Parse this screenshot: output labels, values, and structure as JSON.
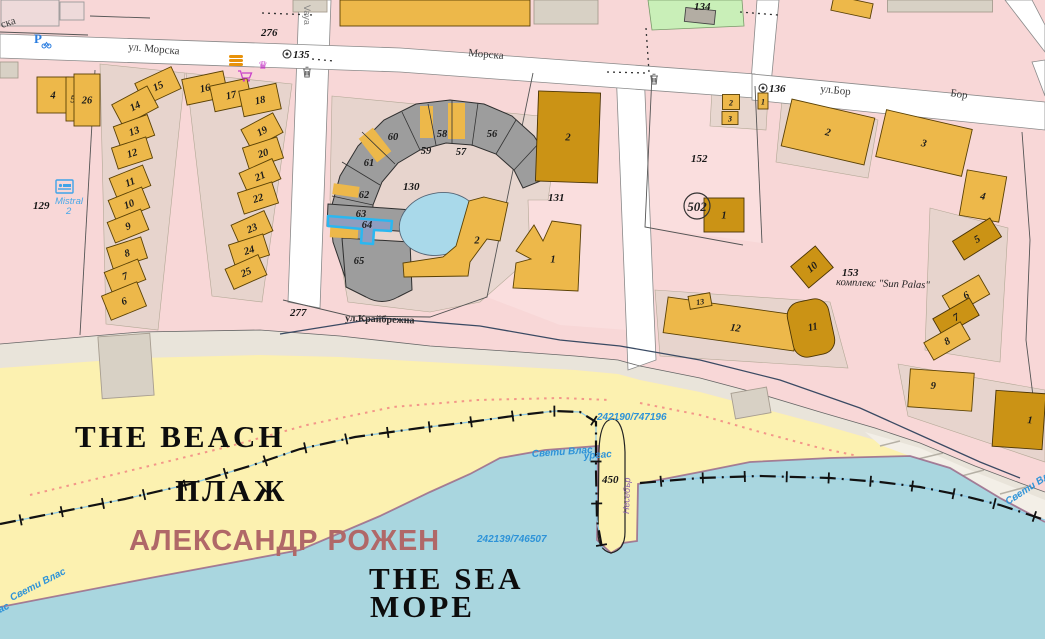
{
  "map": {
    "colors": {
      "urban": "#f8d7d7",
      "road": "#ffffff",
      "beach": "#fcf1b0",
      "sea": "#a9d6df",
      "dune": "#e9e4da",
      "courtyard": "#d8d1c5",
      "green_parcel": "#c9efb8",
      "pond": "#a9d9ea",
      "selected_fill": "#8f9dbf",
      "selected_stroke": "#2bb7f0",
      "shore_edge": "#9b6a8a",
      "blue_text": "#2e93d8",
      "beach_name_text": "#b06868",
      "building_fills": {
        "L": "#edb84a",
        "D": "#cb9315",
        "G": "#9d9d9d",
        "T": "#d8d1c5",
        "P2": "#eedada",
        "G2": "#b3ada3"
      }
    },
    "selected_parcel": {
      "label": "64",
      "note_cls": "highlighted with cyan outline"
    },
    "icons": [
      {
        "name": "parking-icon"
      },
      {
        "name": "hotel-bed-icon"
      },
      {
        "name": "trash-icon"
      },
      {
        "name": "trash-icon"
      },
      {
        "name": "restaurant-icon"
      },
      {
        "name": "crown-icon"
      },
      {
        "name": "shopping-cart-icon"
      },
      {
        "name": "boundary-marker-135"
      },
      {
        "name": "boundary-marker-136"
      }
    ],
    "buildings": [
      {
        "n": "4",
        "x": 53,
        "y": 95,
        "w": 32,
        "h": 36,
        "r": 0,
        "c": "L"
      },
      {
        "n": "5",
        "x": 73,
        "y": 99,
        "w": 14,
        "h": 44,
        "r": 0,
        "c": "L"
      },
      {
        "n": "26",
        "x": 87,
        "y": 100,
        "w": 26,
        "h": 52,
        "r": 0,
        "c": "L"
      },
      {
        "n": "15",
        "x": 158,
        "y": 86,
        "w": 40,
        "h": 24,
        "r": -25,
        "c": "L"
      },
      {
        "n": "14",
        "x": 135,
        "y": 106,
        "w": 40,
        "h": 24,
        "r": -28,
        "c": "L"
      },
      {
        "n": "13",
        "x": 134,
        "y": 131,
        "w": 36,
        "h": 22,
        "r": -20,
        "c": "L"
      },
      {
        "n": "12",
        "x": 132,
        "y": 153,
        "w": 36,
        "h": 22,
        "r": -18,
        "c": "L"
      },
      {
        "n": "11",
        "x": 130,
        "y": 182,
        "w": 36,
        "h": 22,
        "r": -22,
        "c": "L"
      },
      {
        "n": "10",
        "x": 129,
        "y": 204,
        "w": 36,
        "h": 22,
        "r": -22,
        "c": "L"
      },
      {
        "n": "9",
        "x": 128,
        "y": 226,
        "w": 36,
        "h": 22,
        "r": -22,
        "c": "L"
      },
      {
        "n": "8",
        "x": 127,
        "y": 253,
        "w": 36,
        "h": 22,
        "r": -18,
        "c": "L"
      },
      {
        "n": "7",
        "x": 125,
        "y": 276,
        "w": 36,
        "h": 22,
        "r": -22,
        "c": "L"
      },
      {
        "n": "6",
        "x": 124,
        "y": 301,
        "w": 38,
        "h": 26,
        "r": -22,
        "c": "L"
      },
      {
        "n": "16",
        "x": 205,
        "y": 88,
        "w": 42,
        "h": 26,
        "r": -12,
        "c": "L"
      },
      {
        "n": "17",
        "x": 231,
        "y": 95,
        "w": 38,
        "h": 26,
        "r": -12,
        "c": "L"
      },
      {
        "n": "18",
        "x": 260,
        "y": 100,
        "w": 38,
        "h": 26,
        "r": -12,
        "c": "L"
      },
      {
        "n": "19",
        "x": 262,
        "y": 131,
        "w": 36,
        "h": 22,
        "r": -28,
        "c": "L"
      },
      {
        "n": "20",
        "x": 263,
        "y": 153,
        "w": 36,
        "h": 22,
        "r": -18,
        "c": "L"
      },
      {
        "n": "21",
        "x": 260,
        "y": 176,
        "w": 36,
        "h": 22,
        "r": -24,
        "c": "L"
      },
      {
        "n": "22",
        "x": 258,
        "y": 198,
        "w": 36,
        "h": 22,
        "r": -18,
        "c": "L"
      },
      {
        "n": "23",
        "x": 252,
        "y": 228,
        "w": 36,
        "h": 22,
        "r": -24,
        "c": "L"
      },
      {
        "n": "24",
        "x": 249,
        "y": 250,
        "w": 36,
        "h": 22,
        "r": -18,
        "c": "L"
      },
      {
        "n": "25",
        "x": 246,
        "y": 272,
        "w": 36,
        "h": 22,
        "r": -24,
        "c": "L"
      },
      {
        "n": "2",
        "pts": [
          [
            484,
            197
          ],
          [
            508,
            203
          ],
          [
            500,
            241
          ],
          [
            487,
            239
          ],
          [
            470,
            262
          ],
          [
            468,
            276
          ],
          [
            404,
            277
          ],
          [
            403,
            263
          ],
          [
            443,
            257
          ],
          [
            456,
            246
          ],
          [
            469,
            201
          ]
        ],
        "c": "L",
        "lx": 477,
        "ly": 240
      },
      {
        "n": "1",
        "pts": [
          [
            516,
            251
          ],
          [
            534,
            225
          ],
          [
            543,
            241
          ],
          [
            552,
            221
          ],
          [
            581,
            225
          ],
          [
            578,
            291
          ],
          [
            513,
            288
          ],
          [
            516,
            263
          ],
          [
            531,
            259
          ]
        ],
        "c": "L",
        "lx": 553,
        "ly": 259
      },
      {
        "n": "2",
        "x": 568,
        "y": 137,
        "w": 62,
        "h": 90,
        "r": 2,
        "c": "D"
      },
      {
        "n": "2",
        "x": 731,
        "y": 102,
        "w": 17,
        "h": 15,
        "r": 0,
        "c": "L",
        "fs": 1
      },
      {
        "n": "3",
        "x": 730,
        "y": 118,
        "w": 16,
        "h": 13,
        "r": 0,
        "c": "L",
        "fs": 1
      },
      {
        "n": "1",
        "x": 763,
        "y": 101,
        "w": 10,
        "h": 16,
        "r": 0,
        "c": "L",
        "fs": 1
      },
      {
        "n": "1",
        "x": 724,
        "y": 215,
        "w": 40,
        "h": 34,
        "r": 0,
        "c": "D"
      },
      {
        "n": "2",
        "x": 828,
        "y": 132,
        "w": 85,
        "h": 48,
        "r": 13,
        "c": "L"
      },
      {
        "n": "3",
        "x": 924,
        "y": 143,
        "w": 88,
        "h": 48,
        "r": 13,
        "c": "L"
      },
      {
        "n": "4",
        "x": 983,
        "y": 196,
        "w": 40,
        "h": 46,
        "r": 10,
        "c": "L"
      },
      {
        "n": "5",
        "x": 977,
        "y": 239,
        "w": 44,
        "h": 22,
        "r": -32,
        "c": "D"
      },
      {
        "n": "6",
        "x": 966,
        "y": 295,
        "w": 42,
        "h": 22,
        "r": -30,
        "c": "L"
      },
      {
        "n": "7",
        "x": 956,
        "y": 317,
        "w": 42,
        "h": 20,
        "r": -30,
        "c": "D"
      },
      {
        "n": "8",
        "x": 947,
        "y": 341,
        "w": 42,
        "h": 20,
        "r": -30,
        "c": "L"
      },
      {
        "n": "9",
        "x": 941,
        "y": 390,
        "w": 64,
        "h": 38,
        "r": 4,
        "c": "L",
        "lx": 933,
        "ly": 386
      },
      {
        "n": "1",
        "x": 1019,
        "y": 420,
        "w": 50,
        "h": 56,
        "r": 4,
        "c": "D",
        "lx": 1030,
        "ly": 419
      },
      {
        "n": "10",
        "x": 812,
        "y": 267,
        "w": 32,
        "h": 28,
        "r": -40,
        "c": "D"
      },
      {
        "n": "12",
        "x": 731,
        "y": 324,
        "w": 132,
        "h": 36,
        "r": 8,
        "c": "L",
        "lx": 736,
        "ly": 327
      },
      {
        "n": "11",
        "x": 811,
        "y": 328,
        "w": 42,
        "h": 56,
        "r": -12,
        "c": "D",
        "rx": 14,
        "lx": 813,
        "ly": 327
      },
      {
        "n": "13",
        "x": 700,
        "y": 301,
        "w": 22,
        "h": 13,
        "r": -10,
        "c": "L",
        "fs": 1
      },
      {
        "x": 435,
        "y": 13,
        "w": 190,
        "h": 26,
        "r": 0,
        "c": "L"
      },
      {
        "x": 566,
        "y": 12,
        "w": 64,
        "h": 24,
        "r": 0,
        "c": "T"
      },
      {
        "x": 30,
        "y": 13,
        "w": 58,
        "h": 26,
        "r": 0,
        "c": "P2"
      },
      {
        "x": 72,
        "y": 11,
        "w": 24,
        "h": 18,
        "r": 0,
        "c": "P2"
      },
      {
        "x": 310,
        "y": 6,
        "w": 34,
        "h": 12,
        "r": 0,
        "c": "T"
      },
      {
        "x": 700,
        "y": 16,
        "w": 30,
        "h": 14,
        "r": 6,
        "c": "G2"
      },
      {
        "x": 852,
        "y": 7,
        "w": 40,
        "h": 15,
        "r": 12,
        "c": "L"
      },
      {
        "x": 940,
        "y": 6,
        "w": 105,
        "h": 12,
        "r": 0,
        "c": "T"
      },
      {
        "x": 9,
        "y": 70,
        "w": 18,
        "h": 16,
        "r": 0,
        "c": "T"
      },
      {
        "x": 126,
        "y": 366,
        "w": 52,
        "h": 62,
        "r": -4,
        "c": "T"
      },
      {
        "x": 751,
        "y": 403,
        "w": 36,
        "h": 26,
        "r": -10,
        "c": "T"
      }
    ],
    "texts": [
      {
        "t": "ул. Морска",
        "x": 128,
        "y": 50,
        "cls": "street",
        "rot": 5,
        "dn": "street-label-morska"
      },
      {
        "t": "Морска",
        "x": 468,
        "y": 56,
        "cls": "street",
        "rot": 5,
        "dn": "street-label-morska-2"
      },
      {
        "t": "ска",
        "x": 2,
        "y": 28,
        "cls": "street",
        "rot": -18,
        "dn": "street-label-morska-partial"
      },
      {
        "t": "ул.Бор",
        "x": 820,
        "y": 92,
        "cls": "street",
        "rot": 6,
        "dn": "street-label-bor"
      },
      {
        "t": "Бор",
        "x": 950,
        "y": 96,
        "cls": "street",
        "rot": 9,
        "dn": "street-label-bor-2"
      },
      {
        "t": "ул.Крайбрежна",
        "x": 345,
        "y": 321,
        "cls": "street2",
        "rot": 2,
        "dn": "street-label-kraybrezhna"
      },
      {
        "t": "Vaya",
        "x": 304,
        "y": 5,
        "cls": "streetv",
        "rot": 90,
        "dn": "street-label-vaya"
      },
      {
        "t": "129",
        "x": 33,
        "y": 209,
        "cls": "pnum",
        "dn": "parcel-label-129"
      },
      {
        "t": "130",
        "x": 403,
        "y": 190,
        "cls": "pnum",
        "dn": "parcel-label-130"
      },
      {
        "t": "131",
        "x": 548,
        "y": 201,
        "cls": "pnum",
        "dn": "parcel-label-131"
      },
      {
        "t": "134",
        "x": 694,
        "y": 10,
        "cls": "pnum",
        "dn": "parcel-label-134"
      },
      {
        "t": "152",
        "x": 691,
        "y": 162,
        "cls": "pnum",
        "dn": "parcel-label-152"
      },
      {
        "t": "153",
        "x": 842,
        "y": 276,
        "cls": "pnum",
        "dn": "parcel-label-153"
      },
      {
        "t": "276",
        "x": 261,
        "y": 36,
        "cls": "pnum",
        "dn": "marker-label-276"
      },
      {
        "t": "277",
        "x": 290,
        "y": 316,
        "cls": "pnum",
        "dn": "marker-label-277"
      },
      {
        "t": "450",
        "x": 602,
        "y": 483,
        "cls": "pnum",
        "dn": "marker-label-450"
      },
      {
        "t": "135",
        "x": 293,
        "y": 58,
        "cls": "pnum",
        "dn": "marker-label-135"
      },
      {
        "t": "136",
        "x": 769,
        "y": 92,
        "cls": "pnum",
        "dn": "marker-label-136"
      },
      {
        "t": "502",
        "x": 697,
        "y": 211,
        "cls": "pnumbig",
        "a": "middle",
        "dn": "map-sheet-label-502"
      },
      {
        "t": "комплекс \"Sun Palas\"",
        "x": 836,
        "y": 285,
        "cls": "sun",
        "rot": 2,
        "dn": "complex-sun-palas-label"
      },
      {
        "t": "242190/747196",
        "x": 597,
        "y": 420,
        "cls": "blue",
        "dn": "coordinate-label-upper"
      },
      {
        "t": "242139/746507",
        "x": 477,
        "y": 542,
        "cls": "blue",
        "dn": "coordinate-label-lower"
      },
      {
        "t": "Свети Влас",
        "x": 532,
        "y": 457,
        "cls": "blue",
        "rot": -4,
        "dn": "boundary-label-sveti-vlas-mid"
      },
      {
        "t": "ургас",
        "x": 584,
        "y": 459,
        "cls": "blue",
        "rot": -4,
        "dn": "boundary-label-burgas-mid"
      },
      {
        "t": "Свети Влас",
        "x": 12,
        "y": 601,
        "cls": "blue",
        "rot": -27,
        "dn": "boundary-label-sveti-vlas-left"
      },
      {
        "t": "ас",
        "x": 0,
        "y": 613,
        "cls": "blue",
        "rot": -27,
        "dn": "boundary-label-burgas-left"
      },
      {
        "t": "Свети Влас",
        "x": 1008,
        "y": 505,
        "cls": "blue",
        "rot": -33,
        "dn": "boundary-label-sveti-vlas-right"
      },
      {
        "t": "Mistral",
        "x": 55,
        "y": 204,
        "cls": "blue2",
        "dn": "hotel-mistral-label"
      },
      {
        "t": "2",
        "x": 66,
        "y": 214,
        "cls": "blue2",
        "dn": "hotel-mistral-label-2"
      },
      {
        "t": "Несебър",
        "x": 629,
        "y": 514,
        "cls": "purple",
        "rot": -88,
        "dn": "boundary-label-nesebar"
      },
      {
        "t": "THE BEACH",
        "x": 75,
        "y": 447,
        "cls": "bigserif",
        "dn": "label-the-beach"
      },
      {
        "t": "ПЛАЖ",
        "x": 175,
        "y": 501,
        "cls": "bigserif",
        "dn": "label-plazh"
      },
      {
        "t": "АЛЕКСАНДР РОЖЕН",
        "x": 129,
        "y": 550,
        "cls": "bigsans",
        "dn": "label-beach-name-aleksandr-rozhen"
      },
      {
        "t": "THE SEA",
        "x": 369,
        "y": 589,
        "cls": "bigserif",
        "dn": "label-the-sea"
      },
      {
        "t": "МОРЕ",
        "x": 370,
        "y": 617,
        "cls": "bigserif",
        "dn": "label-more"
      },
      {
        "t": "56",
        "x": 492,
        "y": 137,
        "cls": "bnum",
        "a": "middle",
        "dn": "section-label-56"
      },
      {
        "t": "57",
        "x": 461,
        "y": 155,
        "cls": "bnum",
        "a": "middle",
        "dn": "section-label-57"
      },
      {
        "t": "58",
        "x": 442,
        "y": 137,
        "cls": "bnum",
        "a": "middle",
        "dn": "section-label-58"
      },
      {
        "t": "59",
        "x": 426,
        "y": 154,
        "cls": "bnum",
        "a": "middle",
        "dn": "section-label-59"
      },
      {
        "t": "60",
        "x": 393,
        "y": 140,
        "cls": "bnum",
        "a": "middle",
        "dn": "section-label-60"
      },
      {
        "t": "61",
        "x": 369,
        "y": 166,
        "cls": "bnum",
        "a": "middle",
        "dn": "section-label-61"
      },
      {
        "t": "62",
        "x": 364,
        "y": 198,
        "cls": "bnum",
        "a": "middle",
        "dn": "section-label-62"
      },
      {
        "t": "63",
        "x": 361,
        "y": 217,
        "cls": "bnum",
        "a": "middle",
        "dn": "section-label-63"
      },
      {
        "t": "64",
        "x": 367,
        "y": 228,
        "cls": "bnum",
        "a": "middle",
        "dn": "section-label-64-selected"
      },
      {
        "t": "65",
        "x": 359,
        "y": 264,
        "cls": "bnum",
        "a": "middle",
        "dn": "section-label-65"
      }
    ]
  }
}
